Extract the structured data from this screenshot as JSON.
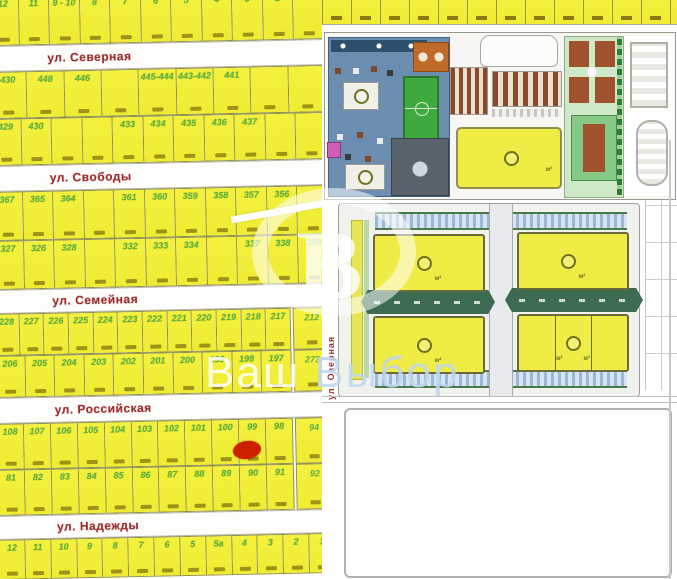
{
  "watermark": {
    "letter": "В",
    "word_left": "Ваш",
    "word_right": "Выбор"
  },
  "map": {
    "streets": [
      "ул. Северная",
      "ул. Свободы",
      "ул. Семейная",
      "ул. Российская",
      "ул. Надежды"
    ],
    "rows": {
      "top": [
        "12",
        "11",
        "9 - 10",
        "8",
        "7",
        "6",
        "5",
        "4",
        "3",
        "2",
        ""
      ],
      "b1": [
        "430",
        "448",
        "446",
        "",
        "445-444",
        "443-442",
        "441",
        "",
        ""
      ],
      "b2": [
        "429",
        "430",
        "",
        "",
        "433",
        "434",
        "435",
        "436",
        "437",
        "",
        ""
      ],
      "c1": [
        "367",
        "365",
        "364",
        "",
        "361",
        "360",
        "359",
        "358",
        "357",
        "356",
        ""
      ],
      "c2": [
        "327",
        "326",
        "328",
        "",
        "332",
        "333",
        "334",
        "",
        "337",
        "338",
        "339"
      ],
      "d1": [
        "228",
        "227",
        "226",
        "225",
        "224",
        "223",
        "222",
        "221",
        "220",
        "219",
        "218",
        "217"
      ],
      "d2": [
        "206",
        "205",
        "204",
        "203",
        "202",
        "201",
        "200",
        "199",
        "198",
        "197"
      ],
      "e1": [
        "108",
        "107",
        "106",
        "105",
        "104",
        "103",
        "102",
        "101",
        "100",
        "99",
        "98"
      ],
      "e2": [
        "81",
        "82",
        "83",
        "84",
        "85",
        "86",
        "87",
        "88",
        "89",
        "90",
        "91"
      ],
      "f": [
        "12",
        "11",
        "10",
        "9",
        "8",
        "7",
        "6",
        "5",
        "5а",
        "4",
        "3",
        "2",
        "1"
      ]
    },
    "right_cells": {
      "d_top": "212",
      "d_bottom": "273",
      "e_top": "94",
      "e_bottom": "92"
    },
    "colors": {
      "plot_fill": "#f2ef3d",
      "plot_number": "#5fae3c",
      "street_text": "#9b2b2b",
      "marker": "#cc2000"
    }
  },
  "masterplan": {
    "vertical_street": "ул. Озерная",
    "area_unit": "м²",
    "icons": [
      "playground-zone",
      "soccer-field-icon",
      "parking-strips",
      "green-median",
      "tree-row"
    ]
  },
  "marker": {
    "type": "red-ellipse",
    "near_plot": "98",
    "street": "ул. Российская"
  }
}
